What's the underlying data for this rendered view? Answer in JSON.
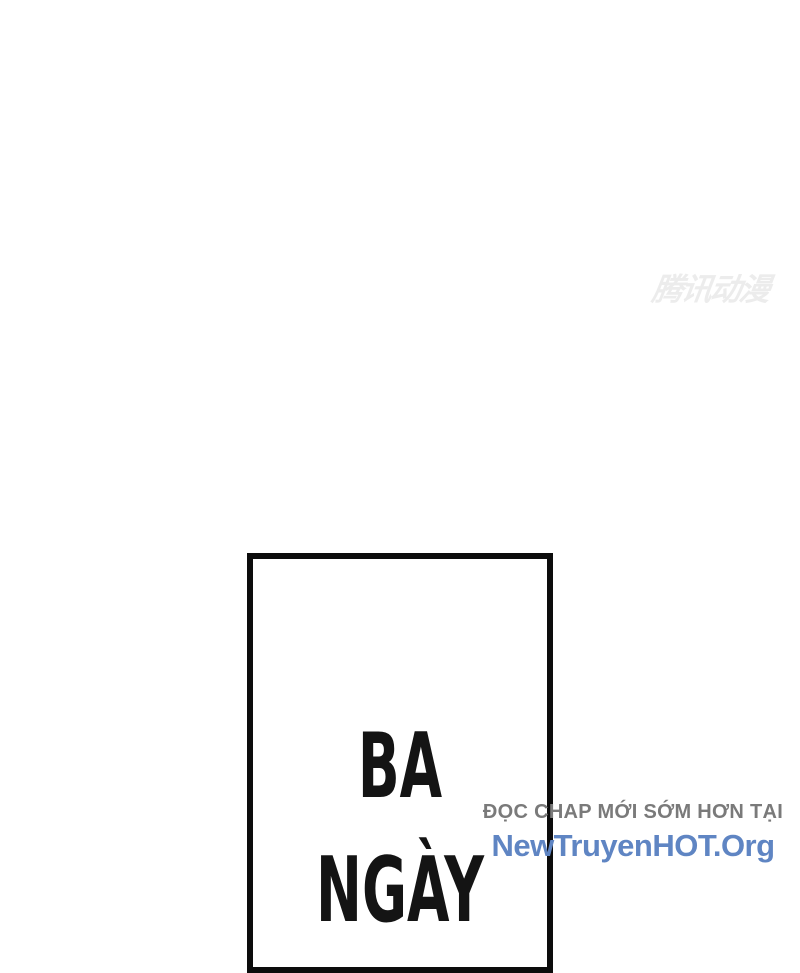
{
  "page": {
    "background_color": "#ffffff",
    "watermark": {
      "text": "腾讯动漫",
      "color": "#ececec"
    },
    "caption_panel": {
      "border_color": "#0c0c0c",
      "text_color": "#141414",
      "lines": [
        "BA",
        "NGÀY"
      ]
    },
    "promo": {
      "line1": "ĐỌC CHAP MỚI SỚM HƠN TẠI",
      "line1_color": "#7a7a7a",
      "line2": "NewTruyenHOT.Org",
      "line2_color": "#5f85c3"
    }
  }
}
